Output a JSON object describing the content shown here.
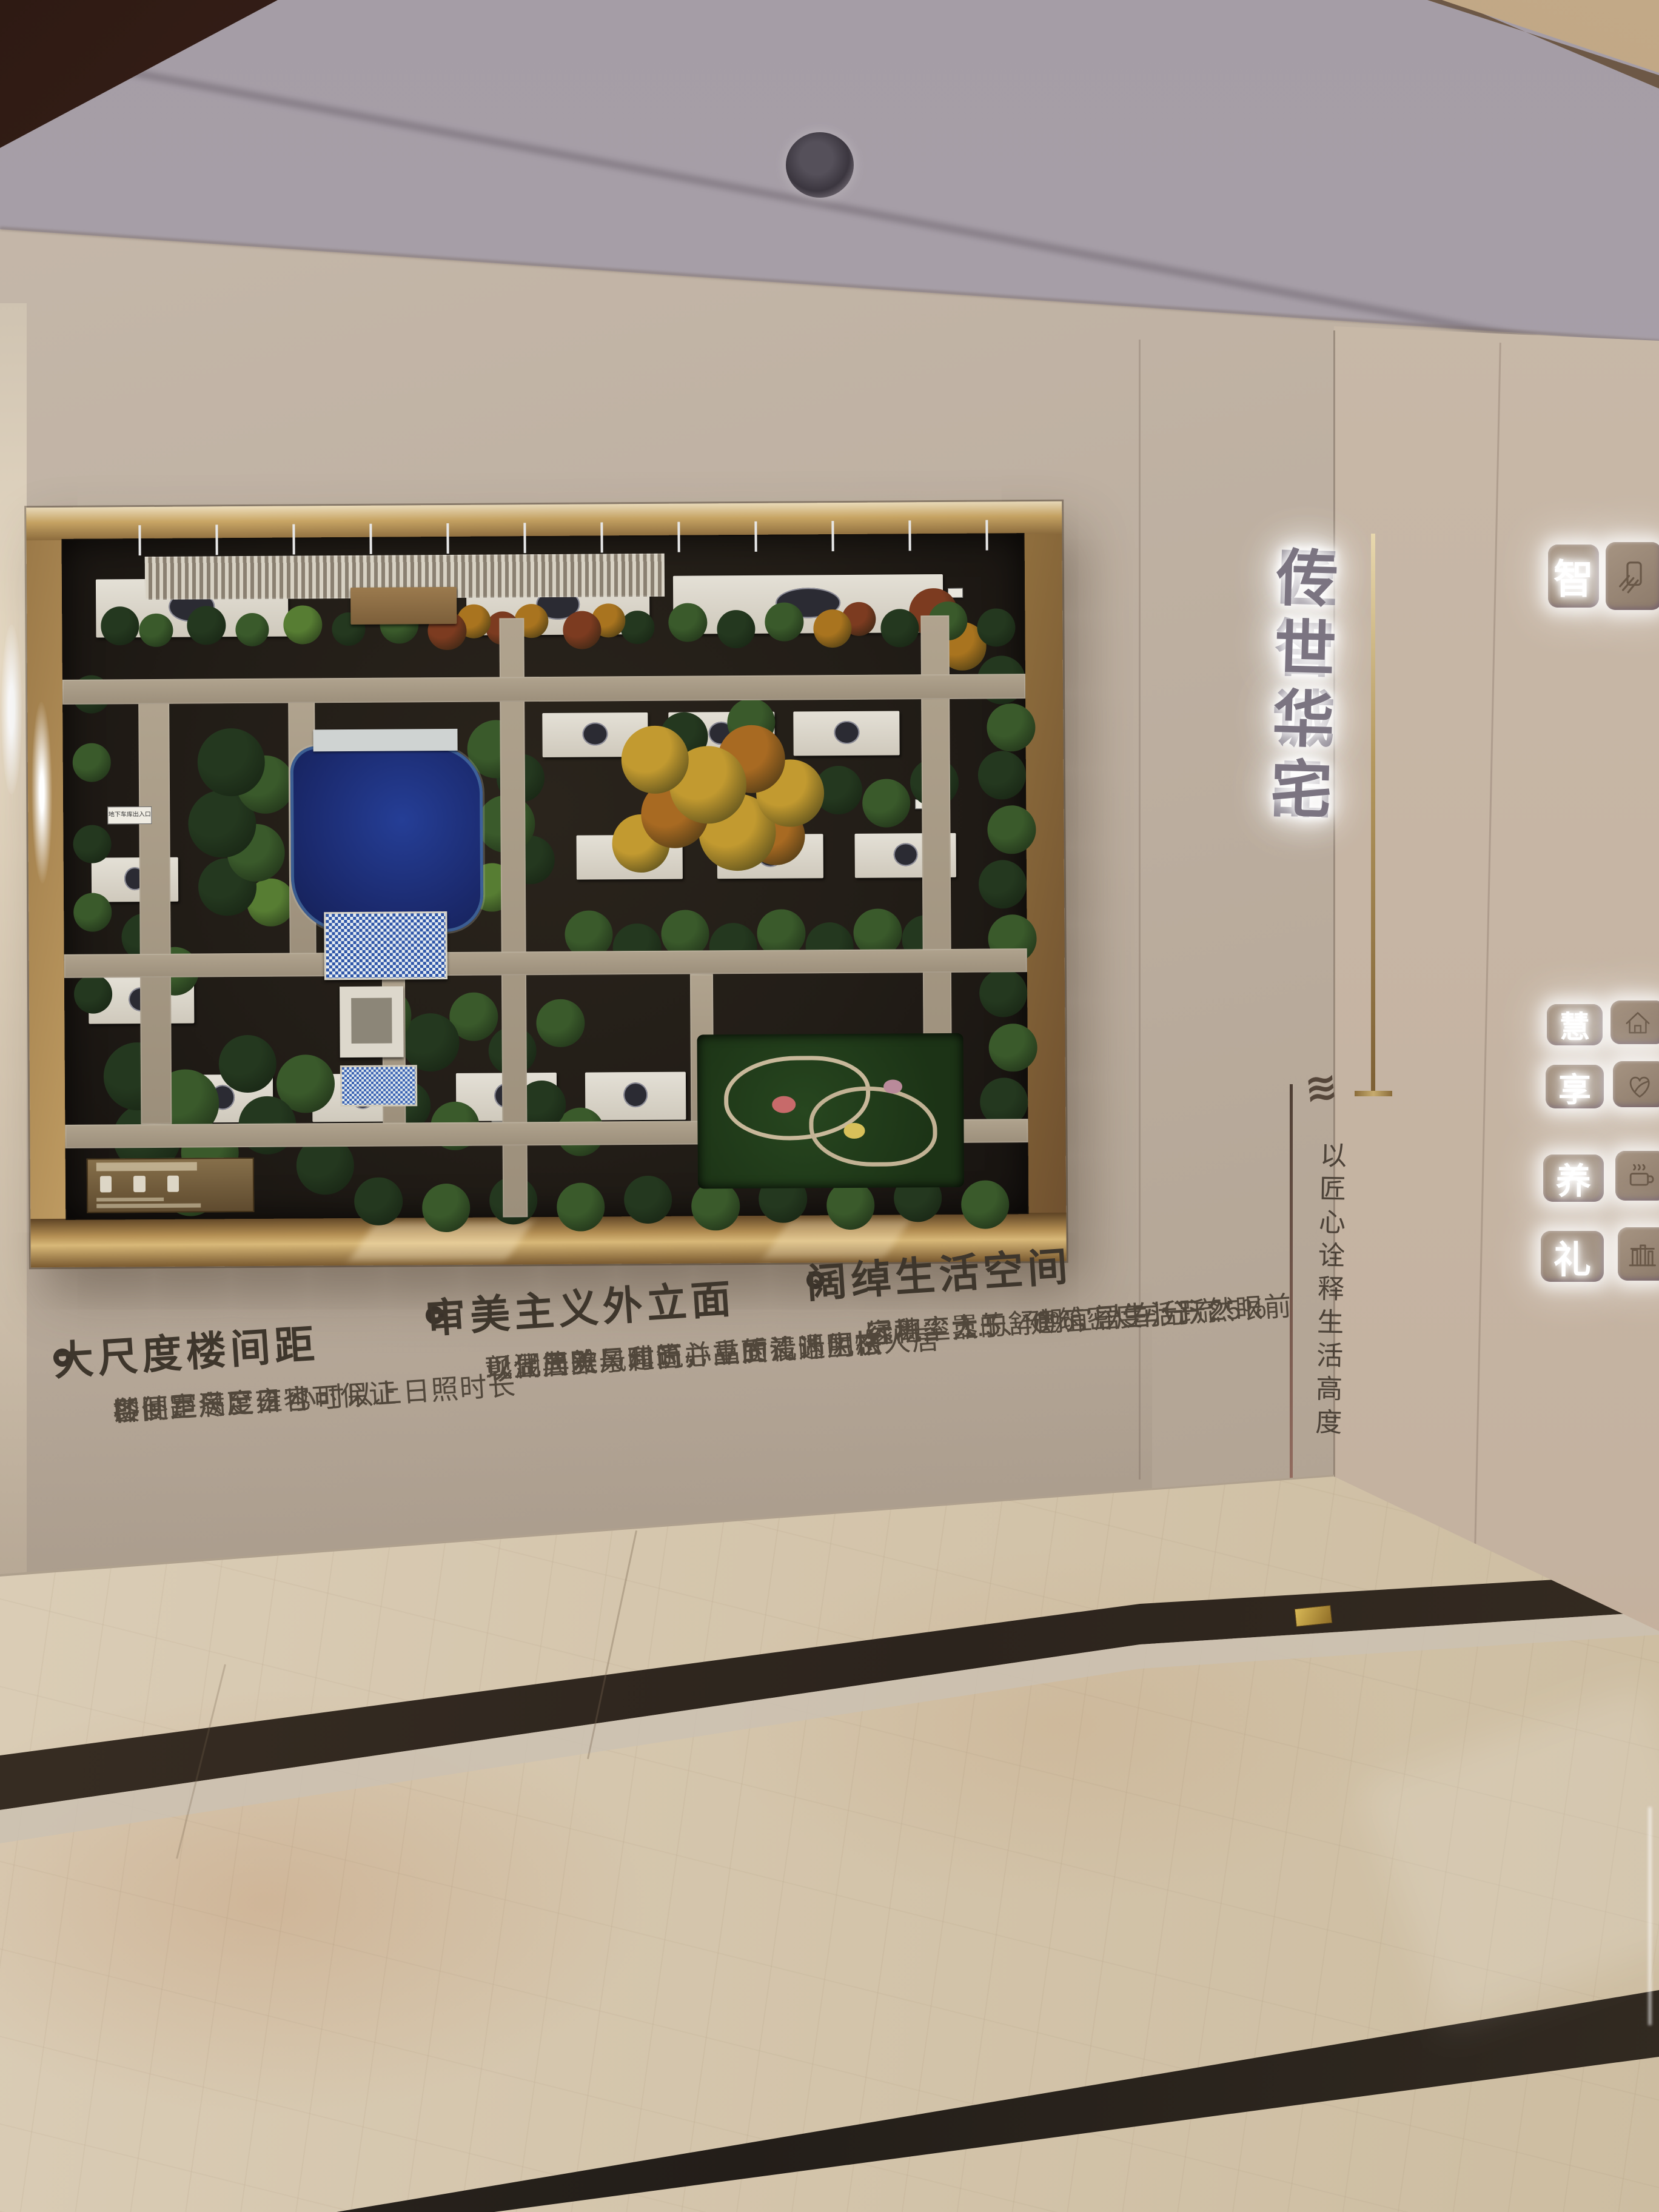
{
  "scene_title": "residential sales gallery display wall",
  "palette": {
    "wall": "#b7a999",
    "ceiling": "#aaa2ab",
    "frame_gold": "#c9a569",
    "board_dark": "#221d17",
    "text_dark": "#43392e",
    "backlit_char": "#7b7481",
    "lake_blue": "#1b2a6e",
    "floor_cream": "#d5c6ad",
    "floor_dark_strip": "#2c241d",
    "tree_colors": [
      "#24381f",
      "#3a5a2b",
      "#577d33",
      "#7c3b20",
      "#a9741f",
      "#c29a30",
      "#a86a22"
    ]
  },
  "wall_sign": {
    "line1": "匠智诚品",
    "line2": "传世华宅",
    "wave_glyph": "≋",
    "motto": "以匠心诠释生活高度"
  },
  "features": [
    {
      "title": "大尺度楼间距",
      "lines": [
        "楼间距尺度雍容",
        "即便是冬至日也可保证",
        "各卧室满足 2 小时以上日照时长"
      ]
    },
    {
      "title": "审美主义外立面",
      "lines": [
        "现代简欧风建筑，立面清晰明快",
        "彰显典雅与时尚并重的设计风格",
        "以湖居美景和匠心品质礼遇生态人居"
      ]
    },
    {
      "title": "阔绰生活空间",
      "lines": [
        "容积率 1.5、建筑密度小于 25%",
        "绿地率大于 40%，人车分流",
        "远离尘嚣的舒朗宜居生活跃然眼前"
      ]
    }
  ],
  "amenity_tiles": [
    {
      "char": "智",
      "icon": "smart-device-icon"
    },
    {
      "char": "慧",
      "icon": "house-icon"
    },
    {
      "char": "享",
      "icon": "heart-leaf-icon"
    },
    {
      "char": "养",
      "icon": "steaming-cup-icon"
    },
    {
      "char": "礼",
      "icon": "pavilion-icon"
    }
  ],
  "model": {
    "garage_sign_label": "地下车库出入口",
    "roads": [
      [
        0,
        20.7,
        100,
        3.6
      ],
      [
        0,
        61,
        100,
        3.5
      ],
      [
        0,
        86,
        100,
        3.5
      ],
      [
        45.4,
        12,
        2.6,
        88
      ],
      [
        89.2,
        12,
        2.9,
        75
      ],
      [
        7.9,
        24,
        3.2,
        62
      ],
      [
        23.4,
        24,
        2.8,
        38
      ],
      [
        33,
        64.5,
        2.4,
        22
      ],
      [
        65,
        64.5,
        2.4,
        22
      ]
    ],
    "pergola": [
      8.6,
      2.7,
      54,
      6.3
    ],
    "buildings": [
      [
        3.5,
        6,
        20,
        8.5
      ],
      [
        42,
        6,
        19,
        8.5
      ],
      [
        63.5,
        6,
        28,
        8.5
      ],
      [
        49.8,
        26,
        11,
        6.5
      ],
      [
        62.9,
        26,
        11,
        6.5
      ],
      [
        75.9,
        26,
        11,
        6.5
      ],
      [
        53.3,
        44,
        11,
        6.5
      ],
      [
        67.9,
        44,
        11,
        6.5
      ],
      [
        82.2,
        44,
        10.5,
        6.5
      ],
      [
        2.9,
        46.8,
        9,
        6.5
      ],
      [
        2.5,
        64.4,
        11,
        6.8
      ],
      [
        11.1,
        78.8,
        10.5,
        7
      ],
      [
        25.7,
        78.8,
        10.5,
        7
      ],
      [
        40.6,
        78.8,
        10.5,
        7
      ],
      [
        54,
        78.8,
        10.5,
        7
      ]
    ],
    "poles": [
      8,
      16,
      24,
      32,
      40,
      48,
      56,
      64,
      72,
      80,
      88,
      96
    ],
    "signs": [
      [
        24,
        61.8
      ],
      [
        44.3,
        85.5
      ],
      [
        57,
        61.8
      ],
      [
        88.5,
        39
      ],
      [
        69,
        61.8
      ],
      [
        20,
        86
      ],
      [
        70,
        86
      ],
      [
        92,
        8
      ]
    ],
    "trees": [
      [
        4,
        10,
        4,
        0
      ],
      [
        8,
        11,
        3.5,
        1
      ],
      [
        13,
        10,
        4,
        0
      ],
      [
        18,
        11,
        3.5,
        1
      ],
      [
        23,
        10,
        4,
        2
      ],
      [
        28,
        11,
        3.5,
        0
      ],
      [
        33,
        10,
        4,
        1
      ],
      [
        38,
        11,
        4,
        3
      ],
      [
        41,
        10,
        3.5,
        4
      ],
      [
        44,
        11,
        3.5,
        3
      ],
      [
        47,
        10,
        3.5,
        4
      ],
      [
        52,
        11,
        4,
        3
      ],
      [
        55,
        10,
        3.5,
        4
      ],
      [
        58,
        11,
        3.5,
        0
      ],
      [
        63,
        10,
        4,
        1
      ],
      [
        68,
        11,
        4,
        0
      ],
      [
        73,
        10,
        4,
        1
      ],
      [
        78,
        11,
        4,
        4
      ],
      [
        81,
        10,
        3.5,
        3
      ],
      [
        85,
        11,
        4,
        0
      ],
      [
        90,
        10,
        4,
        1
      ],
      [
        95,
        11,
        4,
        0
      ],
      [
        88,
        8,
        5,
        3
      ],
      [
        91,
        13,
        5,
        4
      ],
      [
        14,
        28,
        7,
        0
      ],
      [
        18,
        32,
        6,
        1
      ],
      [
        13,
        37,
        7,
        0
      ],
      [
        17,
        42,
        6,
        1
      ],
      [
        14,
        47,
        6,
        0
      ],
      [
        19,
        50,
        5,
        2
      ],
      [
        42,
        27,
        6,
        1
      ],
      [
        45,
        32,
        5,
        0
      ],
      [
        43,
        38,
        6,
        1
      ],
      [
        46,
        44,
        5,
        0
      ],
      [
        42,
        48,
        5,
        2
      ],
      [
        58,
        28,
        7,
        5
      ],
      [
        63,
        31,
        8,
        5
      ],
      [
        68,
        28,
        7,
        6
      ],
      [
        72,
        33,
        7,
        5
      ],
      [
        60,
        36,
        7,
        6
      ],
      [
        66,
        38,
        8,
        5
      ],
      [
        71,
        40,
        6,
        6
      ],
      [
        57,
        41,
        6,
        5
      ],
      [
        62,
        26,
        5,
        0
      ],
      [
        69,
        24,
        5,
        1
      ],
      [
        78,
        34,
        5,
        0
      ],
      [
        83,
        36,
        5,
        1
      ],
      [
        88,
        33,
        5,
        0
      ],
      [
        52,
        55,
        5,
        1
      ],
      [
        57,
        57,
        5,
        0
      ],
      [
        62,
        55,
        5,
        1
      ],
      [
        67,
        57,
        5,
        0
      ],
      [
        72,
        55,
        5,
        1
      ],
      [
        77,
        57,
        5,
        0
      ],
      [
        82,
        55,
        5,
        1
      ],
      [
        87,
        56,
        5,
        0
      ],
      [
        6,
        55,
        5,
        0
      ],
      [
        9,
        60,
        5,
        1
      ],
      [
        4,
        74,
        7,
        0
      ],
      [
        9,
        78,
        7,
        1
      ],
      [
        5,
        83,
        7,
        0
      ],
      [
        12,
        86,
        6,
        1
      ],
      [
        18,
        82,
        6,
        0
      ],
      [
        22,
        76,
        6,
        1
      ],
      [
        16,
        73,
        6,
        0
      ],
      [
        24,
        88,
        6,
        0
      ],
      [
        10,
        91,
        6,
        1
      ],
      [
        30,
        66,
        6,
        1
      ],
      [
        35,
        70,
        6,
        0
      ],
      [
        40,
        67,
        5,
        1
      ],
      [
        44,
        72,
        5,
        0
      ],
      [
        49,
        68,
        5,
        1
      ],
      [
        33,
        80,
        5,
        0
      ],
      [
        38,
        83,
        5,
        1
      ],
      [
        47,
        80,
        5,
        0
      ],
      [
        51,
        84,
        5,
        1
      ],
      [
        95,
        18,
        5,
        0
      ],
      [
        96,
        25,
        5,
        1
      ],
      [
        95,
        32,
        5,
        0
      ],
      [
        96,
        40,
        5,
        1
      ],
      [
        95,
        48,
        5,
        0
      ],
      [
        96,
        56,
        5,
        1
      ],
      [
        95,
        64,
        5,
        0
      ],
      [
        96,
        72,
        5,
        1
      ],
      [
        95,
        80,
        5,
        0
      ],
      [
        1,
        20,
        4,
        0
      ],
      [
        1,
        30,
        4,
        1
      ],
      [
        1,
        42,
        4,
        0
      ],
      [
        1,
        52,
        4,
        1
      ],
      [
        1,
        64,
        4,
        0
      ],
      [
        30,
        94,
        5,
        0
      ],
      [
        37,
        95,
        5,
        1
      ],
      [
        44,
        94,
        5,
        0
      ],
      [
        51,
        95,
        5,
        1
      ],
      [
        58,
        94,
        5,
        0
      ],
      [
        65,
        95,
        5,
        1
      ],
      [
        72,
        94,
        5,
        0
      ],
      [
        79,
        95,
        5,
        1
      ],
      [
        86,
        94,
        5,
        0
      ],
      [
        93,
        95,
        5,
        1
      ]
    ]
  }
}
